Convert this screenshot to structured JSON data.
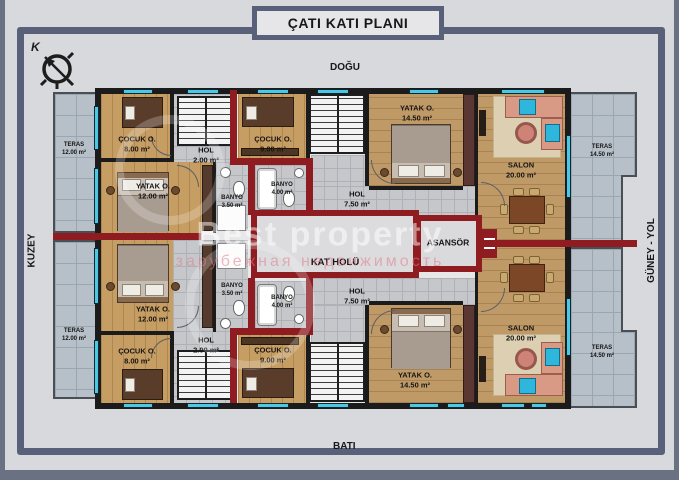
{
  "title": "ÇATI KATI PLANI",
  "directions": {
    "top": "DOĞU",
    "bottom": "BATI",
    "left": "KUZEY",
    "right": "GÜNEY - YOL",
    "compass_letter": "K"
  },
  "watermark": {
    "line1": "Best property",
    "line2": "зарубежная недвижимость"
  },
  "colors": {
    "frame": "#59617a",
    "red_wall": "#8e1c20",
    "black_wall": "#1b1b1b",
    "window": "#49c8e8",
    "wood": "#c69d62",
    "terrace_tile": "#b7c0c8",
    "hall_tile": "#c6c7cb"
  },
  "rooms": {
    "teras_tl": {
      "name": "TERAS",
      "area": "12.00 m²"
    },
    "cocuk_tl": {
      "name": "ÇOCUK O.",
      "area": "8.00 m²"
    },
    "hol_tl": {
      "name": "HOL",
      "area": "2.00 m²"
    },
    "yatak_tl": {
      "name": "YATAK O.",
      "area": "12.00 m²"
    },
    "banyo_tl": {
      "name": "BANYO",
      "area": "3.50 m²"
    },
    "cocuk_tm": {
      "name": "ÇOCUK O.",
      "area": "9.00 m²"
    },
    "banyo_tm": {
      "name": "BANYO",
      "area": "4.00 m²"
    },
    "hol_tm": {
      "name": "HOL",
      "area": "7.50 m²"
    },
    "yatak_tr": {
      "name": "YATAK O.",
      "area": "14.50 m²"
    },
    "salon_tr": {
      "name": "SALON",
      "area": "20.00 m²"
    },
    "teras_tr": {
      "name": "TERAS",
      "area": "14.50 m²"
    },
    "kat_holu": {
      "name": "KAT HOLÜ"
    },
    "asansor": {
      "name": "ASANSÖR"
    },
    "teras_bl": {
      "name": "TERAS",
      "area": "12.00 m²"
    },
    "yatak_bl": {
      "name": "YATAK O.",
      "area": "12.00 m²"
    },
    "banyo_bl": {
      "name": "BANYO",
      "area": "3.50 m²"
    },
    "cocuk_bl": {
      "name": "ÇOCUK O.",
      "area": "8.00 m²"
    },
    "hol_bl": {
      "name": "HOL",
      "area": "2.00 m²"
    },
    "banyo_bm": {
      "name": "BANYO",
      "area": "4.00 m²"
    },
    "cocuk_bm": {
      "name": "ÇOCUK O.",
      "area": "9.00 m²"
    },
    "hol_bm": {
      "name": "HOL",
      "area": "7.50 m²"
    },
    "yatak_br": {
      "name": "YATAK O.",
      "area": "14.50 m²"
    },
    "salon_br": {
      "name": "SALON",
      "area": "20.00 m²"
    },
    "teras_br": {
      "name": "TERAS",
      "area": "14.50 m²"
    }
  }
}
